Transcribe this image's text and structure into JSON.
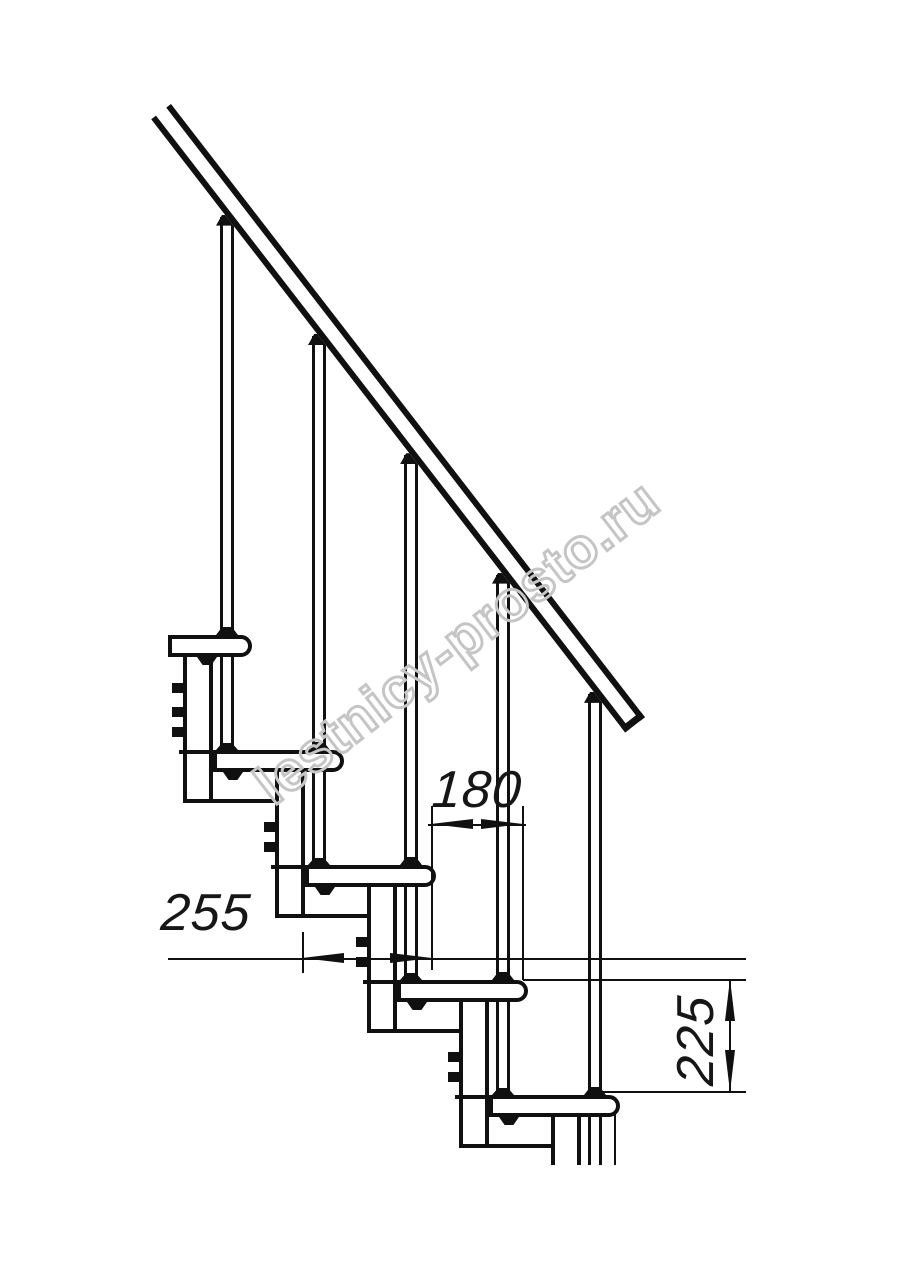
{
  "figure": {
    "kind": "staircase-side-elevation-technical-drawing",
    "ink_color": "#101010",
    "watermark": {
      "text": "lestnicy-prosto.ru",
      "color": "#c5c5c5"
    },
    "dimensions": {
      "going": {
        "label": "180",
        "orientation": "horizontal"
      },
      "tread_depth": {
        "label": "255",
        "orientation": "horizontal"
      },
      "rise": {
        "label": "225",
        "orientation": "vertical"
      }
    },
    "steps_visible": 5,
    "balusters_visible": 5,
    "handrail": "diagonal, top-left to mid-right"
  }
}
